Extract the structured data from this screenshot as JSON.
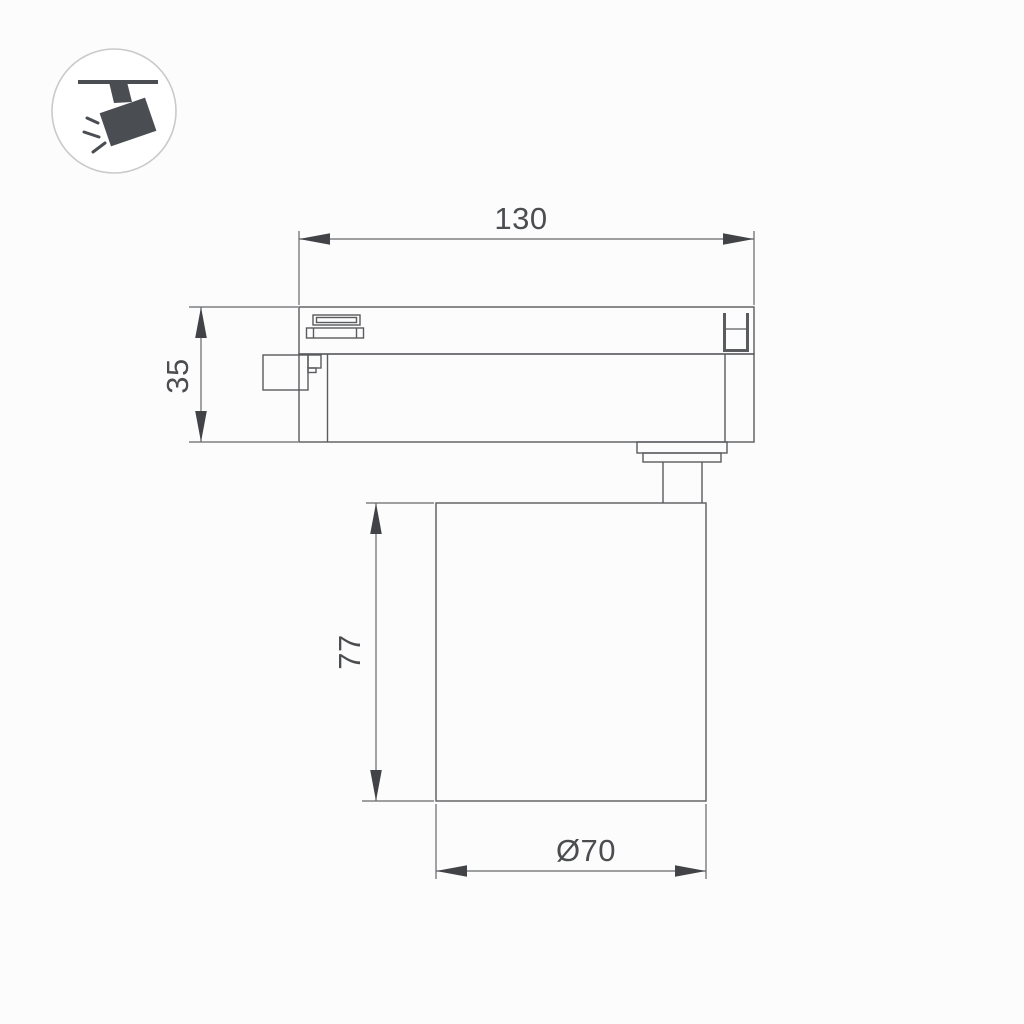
{
  "page": {
    "background": "#fcfcfc",
    "description_labels": []
  },
  "icon": {
    "name": "track-spotlight-icon",
    "circle_stroke": "#c9cacb",
    "circle_fill": "#ffffff",
    "glyph_color": "#4a4e53"
  },
  "drawing": {
    "part_line_color": "#5a5b5e",
    "dimension_line_color": "#66676a",
    "arrow_color": "#424347",
    "text_color": "#4c4d50",
    "dimensions": {
      "track_length": {
        "label": "130"
      },
      "adapter_height": {
        "label": "35"
      },
      "body_height": {
        "label": "77"
      },
      "body_diameter": {
        "label": "Ø70"
      }
    }
  }
}
